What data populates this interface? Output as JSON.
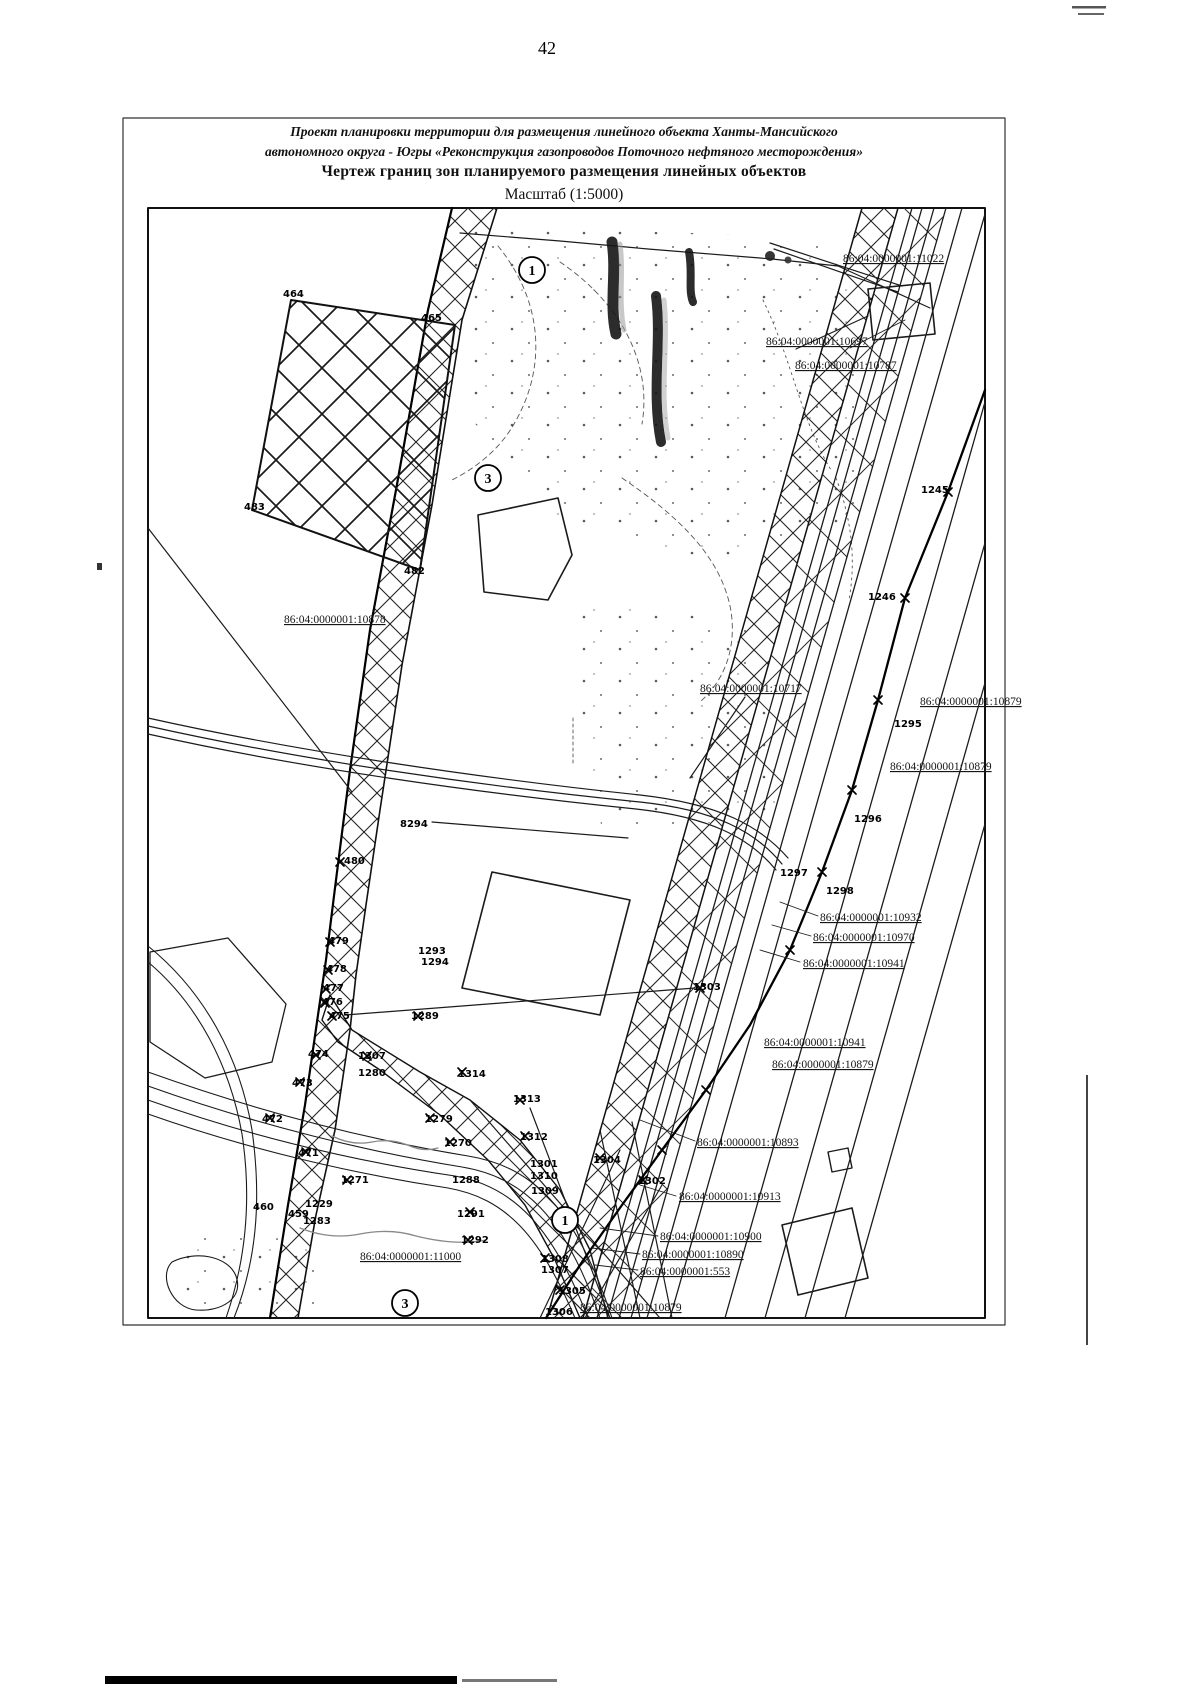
{
  "page": {
    "number": "42"
  },
  "title": {
    "line1": "Проект планировки территории для размещения линейного объекта Ханты-Мансийского",
    "line2": "автономного округа - Югры «Реконструкция газопроводов Поточного нефтяного месторождения»",
    "line3": "Чертеж границ зон планируемого размещения линейных объектов",
    "line4": "Масштаб (1:5000)"
  },
  "map": {
    "scale": "1:5000",
    "colors": {
      "ink": "#1b1b1b",
      "paper": "#ffffff"
    },
    "cadastral_labels": [
      {
        "t": "86:04:0000001:11022"
      },
      {
        "t": "86:04:0000001:10697"
      },
      {
        "t": "86:04:0000001:10787"
      },
      {
        "t": "86:04:0000001:10878"
      },
      {
        "t": "86:04:0000001:10717"
      },
      {
        "t": "86:04:0000001:10879"
      },
      {
        "t": "86:04:0000001:10879"
      },
      {
        "t": "86:04:0000001:10932"
      },
      {
        "t": "86:04:0000001:10970"
      },
      {
        "t": "86:04:0000001:10941"
      },
      {
        "t": "86:04:0000001:10941"
      },
      {
        "t": "86:04:0000001:10879"
      },
      {
        "t": "86:04:0000001:10893"
      },
      {
        "t": "86:04:0000001:10913"
      },
      {
        "t": "86:04:0000001:10900"
      },
      {
        "t": "86:04:0000001:10890"
      },
      {
        "t": "86:04:0000001:553"
      },
      {
        "t": "86:04:0000001:11000"
      },
      {
        "t": "86:04:0000001:10879"
      }
    ],
    "point_labels": [
      {
        "t": "464"
      },
      {
        "t": "465"
      },
      {
        "t": "483"
      },
      {
        "t": "482"
      },
      {
        "t": "8294"
      },
      {
        "t": "480"
      },
      {
        "t": "479"
      },
      {
        "t": "478"
      },
      {
        "t": "477"
      },
      {
        "t": "476"
      },
      {
        "t": "475"
      },
      {
        "t": "1293"
      },
      {
        "t": "1294"
      },
      {
        "t": "474"
      },
      {
        "t": "1307"
      },
      {
        "t": "1280"
      },
      {
        "t": "1289"
      },
      {
        "t": "1314"
      },
      {
        "t": "1313"
      },
      {
        "t": "1279"
      },
      {
        "t": "1270"
      },
      {
        "t": "1312"
      },
      {
        "t": "473"
      },
      {
        "t": "472"
      },
      {
        "t": "471"
      },
      {
        "t": "1271"
      },
      {
        "t": "460"
      },
      {
        "t": "459"
      },
      {
        "t": "1229"
      },
      {
        "t": "1283"
      },
      {
        "t": "1288"
      },
      {
        "t": "1291"
      },
      {
        "t": "1292"
      },
      {
        "t": "1301"
      },
      {
        "t": "1310"
      },
      {
        "t": "1309"
      },
      {
        "t": "1308"
      },
      {
        "t": "1307"
      },
      {
        "t": "1305"
      },
      {
        "t": "1306"
      },
      {
        "t": "1304"
      },
      {
        "t": "1302"
      },
      {
        "t": "1303"
      },
      {
        "t": "1295"
      },
      {
        "t": "1296"
      },
      {
        "t": "1297"
      },
      {
        "t": "1298"
      },
      {
        "t": "1245"
      },
      {
        "t": "1246"
      }
    ],
    "markers": [
      {
        "t": "1"
      },
      {
        "t": "3"
      },
      {
        "t": "1"
      },
      {
        "t": "3"
      }
    ]
  }
}
